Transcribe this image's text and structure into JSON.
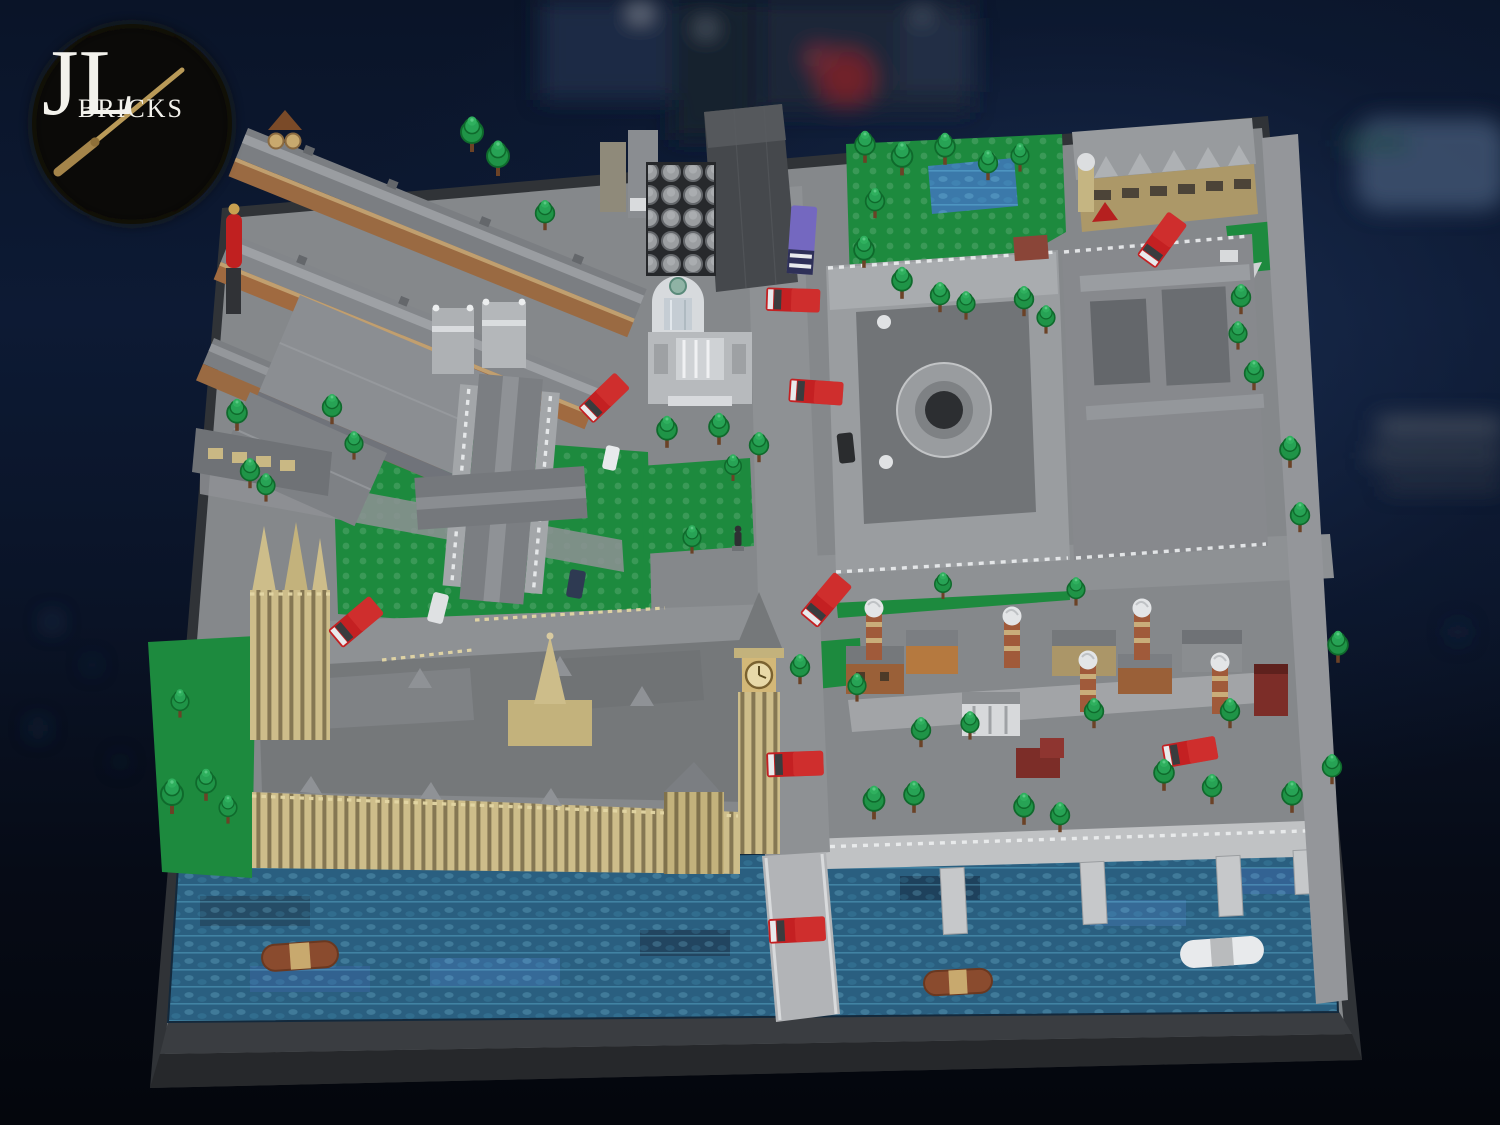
{
  "logo": {
    "initials": "JL",
    "word": "BRICKS"
  },
  "palette": {
    "background_navy": "#0d1a34",
    "baseplate_dark": "#303337",
    "ground_gray": "#85888b",
    "road_gray": "#8e9194",
    "sidewalk_light": "#c2c4c6",
    "water_teal": "#2a5f80",
    "water_highlight": "#57c8e8",
    "grass_green": "#1d8a3e",
    "tree_green": "#1f9447",
    "trunk_brown": "#6b4226",
    "bus_red": "#c42022",
    "tan_cream": "#cdbd8a",
    "facade_brown": "#9a6a42",
    "building_gray_light": "#9ea1a4",
    "building_gray_mid": "#7b7e82",
    "building_gray_dark": "#45484c",
    "dome_white": "#dfe2e4",
    "van_purple": "#7468c0",
    "dark_red_house": "#7c2d28",
    "logo_circle": "#0b0a08",
    "wand_gold": "#b99a58"
  }
}
